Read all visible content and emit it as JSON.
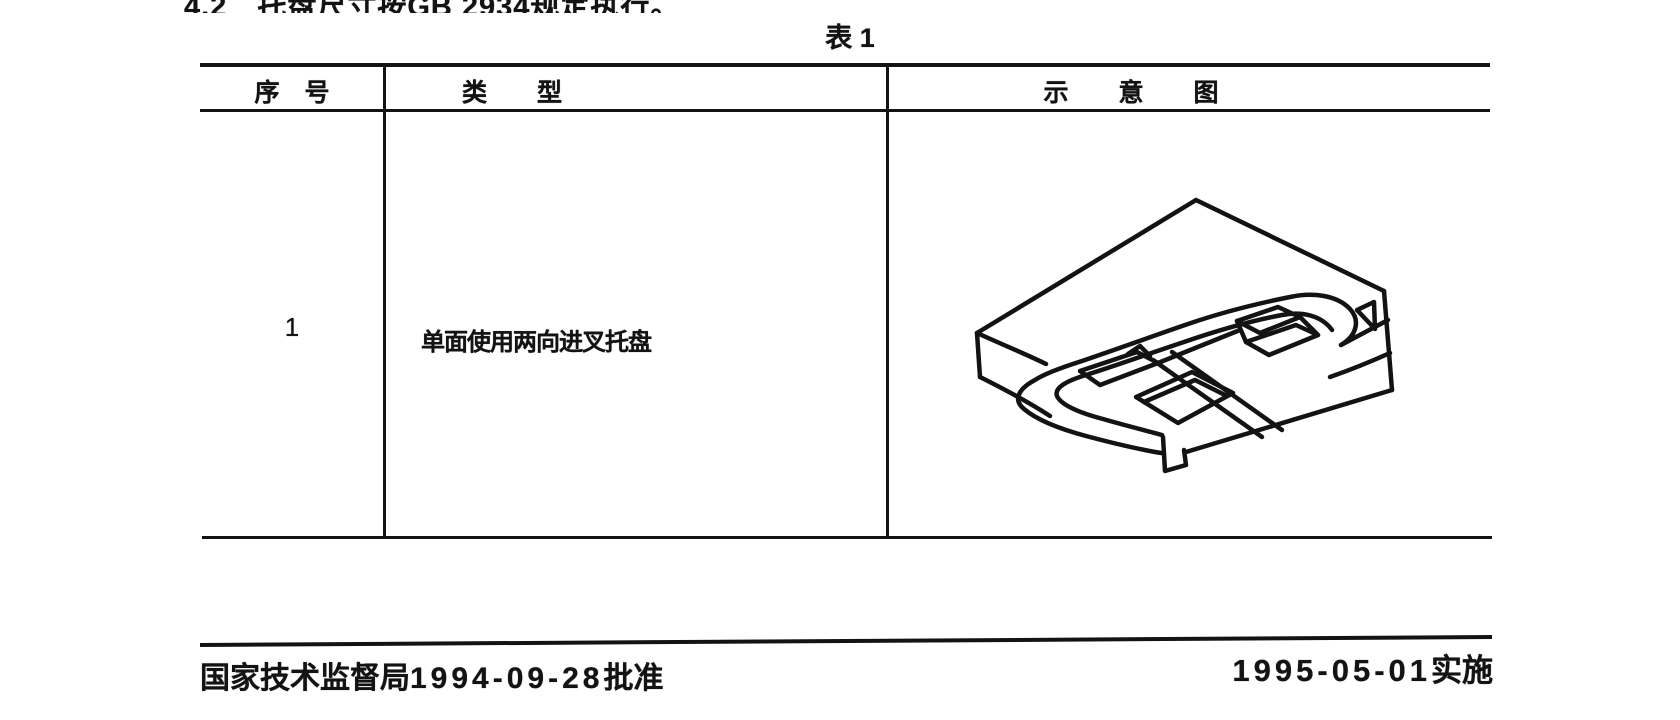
{
  "page": {
    "top_clipped_line": "4.2　托盘尺寸按GB 2934规定执行。",
    "table_caption": "表 1"
  },
  "table": {
    "columns": [
      {
        "label": "序　号"
      },
      {
        "label": "类　　型"
      },
      {
        "label": "示　　意　　图"
      }
    ],
    "rows": [
      {
        "no": "1",
        "type": "单面使用两向进叉托盘",
        "diagram_icon": "pallet-isometric-line-drawing"
      }
    ]
  },
  "footer": {
    "approval_org": "国家技术监督局",
    "approval_date": "1994-09-28",
    "approval_suffix": "批准",
    "implement_date": "1995-05-01",
    "implement_suffix": "实施"
  },
  "colors": {
    "ink": "#131313",
    "paper": "#ffffff"
  }
}
